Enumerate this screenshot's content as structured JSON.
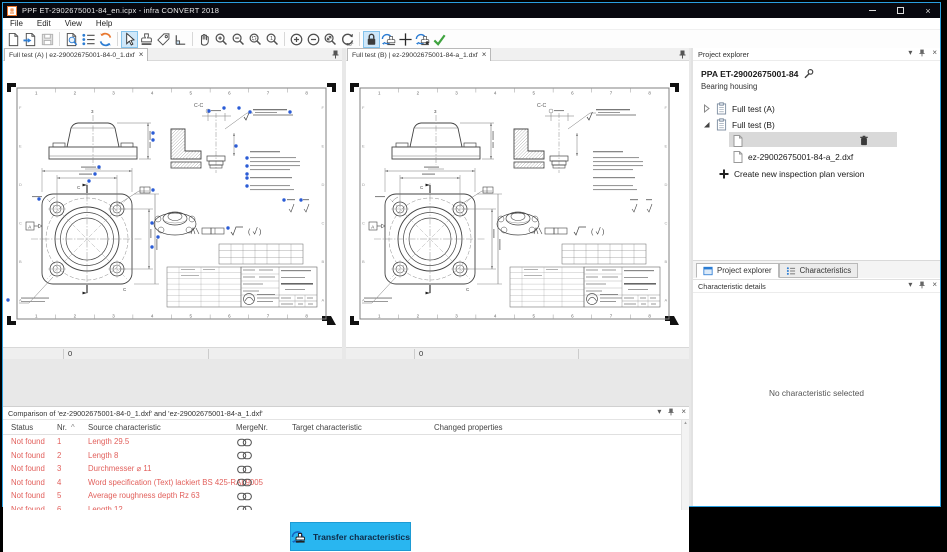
{
  "window": {
    "title": "PPF ET-2902675001-84_en.icpx - infra CONVERT 2018"
  },
  "menu": {
    "items": [
      "File",
      "Edit",
      "View",
      "Help"
    ]
  },
  "toolbar": {
    "icons": [
      {
        "name": "new-document-icon"
      },
      {
        "name": "open-document-icon"
      },
      {
        "name": "save-icon"
      },
      {
        "sep": true
      },
      {
        "name": "find-in-document-icon"
      },
      {
        "name": "characteristics-list-icon"
      },
      {
        "name": "update-drawing-icon"
      },
      {
        "sep": true
      },
      {
        "name": "select-cursor-icon",
        "active": true
      },
      {
        "name": "stamp-tool-icon"
      },
      {
        "name": "tag-tool-icon"
      },
      {
        "name": "corner-tool-icon"
      },
      {
        "sep": true
      },
      {
        "name": "pan-hand-icon"
      },
      {
        "name": "zoom-in-icon"
      },
      {
        "name": "zoom-out-icon"
      },
      {
        "name": "zoom-selection-icon"
      },
      {
        "name": "zoom-original-icon"
      },
      {
        "sep": true
      },
      {
        "name": "increase-icon"
      },
      {
        "name": "decrease-icon"
      },
      {
        "name": "zoom-fit-icon"
      },
      {
        "name": "rotate-90-icon"
      },
      {
        "sep": true
      },
      {
        "name": "lock-icon",
        "active": true
      },
      {
        "name": "transfer-stamp-icon"
      },
      {
        "name": "crosshair-icon"
      },
      {
        "name": "transfer-stamp-settings-icon"
      },
      {
        "name": "apply-check-icon"
      }
    ]
  },
  "tabs": {
    "a": {
      "label": "Full test (A) | ez-29002675001-84-0_1.dxf"
    },
    "b": {
      "label": "Full test (B) | ez-29002675001-84-a_1.dxf"
    }
  },
  "drawing": {
    "section_label": "C-C",
    "ruler_numbers": [
      "1",
      "2",
      "3",
      "4",
      "5",
      "6",
      "7",
      "8"
    ],
    "zone_letters": [
      "A",
      "B",
      "C",
      "D",
      "E",
      "F"
    ],
    "section_arrow_label": "C",
    "datum_label": "A",
    "top_mark_label": "3",
    "status_value": "0"
  },
  "project_explorer": {
    "title": "Project explorer",
    "project_name": "PPA ET-29002675001-84",
    "project_subtitle": "Bearing housing",
    "tree": [
      {
        "label": "Full test (A)",
        "expanded": false
      },
      {
        "label": "Full test (B)",
        "expanded": true,
        "children": [
          {
            "label": "ez-29002675001-84-a_1.dxf",
            "selected": true
          },
          {
            "label": "ez-29002675001-84-a_2.dxf",
            "selected": false
          }
        ]
      }
    ],
    "create_action": "Create new inspection plan version"
  },
  "sidebar_tabs": {
    "project_explorer": "Project explorer",
    "characteristics": "Characteristics"
  },
  "characteristic_details": {
    "title": "Characteristic details",
    "empty_message": "No characteristic selected"
  },
  "comparison": {
    "title": "Comparison of 'ez-29002675001-84-0_1.dxf' and 'ez-29002675001-84-a_1.dxf'",
    "columns": [
      "Status",
      "Nr.",
      "Source characteristic",
      "Merge",
      "Nr.",
      "Target characteristic",
      "Changed properties"
    ],
    "sort_glyph": "^",
    "rows": [
      {
        "status": "Not found",
        "nr": "1",
        "source": "Length 29.5"
      },
      {
        "status": "Not found",
        "nr": "2",
        "source": "Length 8"
      },
      {
        "status": "Not found",
        "nr": "3",
        "source": "Durchmesser ⌀ 11"
      },
      {
        "status": "Not found",
        "nr": "4",
        "source": "Word specification (Text) lackiert BS 425-RAL9005"
      },
      {
        "status": "Not found",
        "nr": "5",
        "source": "Average roughness depth Rz 63"
      },
      {
        "status": "Not found",
        "nr": "6",
        "source": "Length 12"
      },
      {
        "status": "Not found",
        "nr": "7",
        "source": "Length 46"
      }
    ],
    "transfer_button": "Transfer characteristics"
  },
  "ui": {
    "dropdown_glyph": "▾",
    "close_glyph": "×"
  },
  "colors": {
    "accent_cyan": "#29b6f0",
    "error_red": "#e2605c",
    "marker_blue": "#2b5cd6",
    "toolbar_blue": "#2b7cd3",
    "toolbar_orange": "#e8772e",
    "check_green": "#3fa33f",
    "titlebar": "#08080f"
  }
}
